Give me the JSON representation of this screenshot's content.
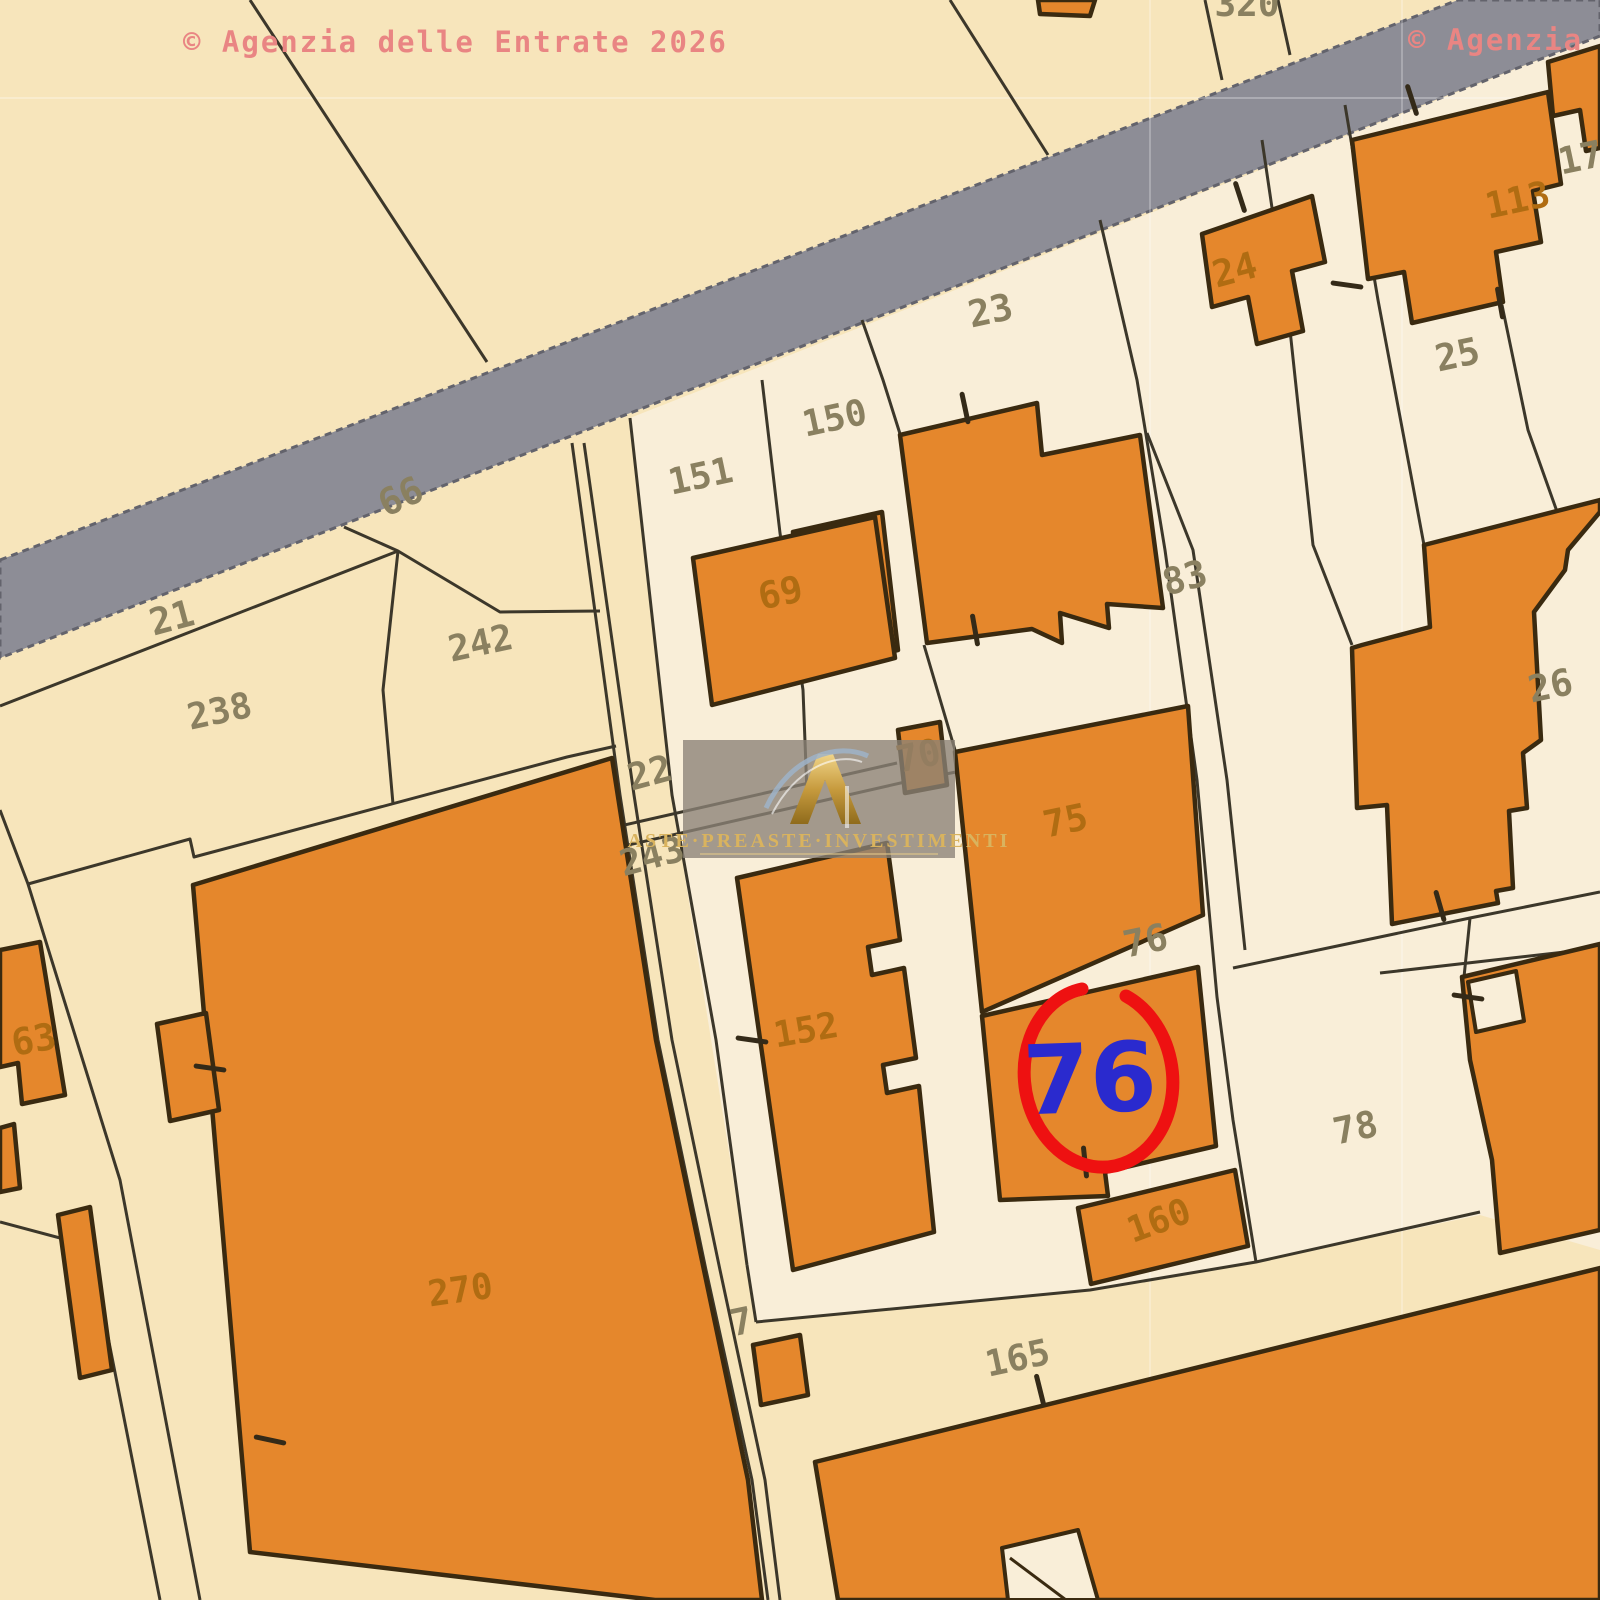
{
  "copyright": {
    "left": "© Agenzia delle Entrate 2026",
    "right": "© Agenzia"
  },
  "watermark": {
    "brand": "ASTE·PREASTE·INVESTIMENTI"
  },
  "colors": {
    "cream": "#f7e5bb",
    "cream_light": "#f9eed8",
    "road": "#8d8d96",
    "road_edge": "#63636c",
    "orange": "#e5872c",
    "building_stroke": "#3a2a10",
    "line": "#3c372a",
    "parcel_label": "#8a8060",
    "building_label": "#b06c12",
    "pink": "#e98583",
    "red": "#ee1111",
    "blue": "#2a2ace",
    "gold": "#d9b35e",
    "watermark_box": "rgba(138,130,118,0.78)"
  },
  "map": {
    "road": "0,560 1458,0 1600,0 1600,36 0,658",
    "light_zone": "630,418 1600,36 1600,1250 1480,1215 1256,1262 1090,1290 756,1322 747,1265 672,795",
    "grid": {
      "h": [
        98
      ],
      "v": [
        1150,
        1402
      ]
    },
    "boundaries": [
      "250,0 487,362",
      "950,0 1048,155",
      "1205,0 1222,80",
      "1278,0 1290,55",
      "0,706 398,551",
      "344,527 398,551 500,612 600,611",
      "398,551 383,690 393,804",
      "572,443 620,795 658,1040 706,1270 752,1480 768,1600",
      "584,443 634,795 672,1040 720,1270 765,1480 780,1600",
      "630,418 672,795 716,1040 747,1265",
      "620,826 897,763",
      "624,846 905,782 956,772",
      "28,884 190,839 194,857 567,757 616,746",
      "0,810 28,884 120,1180 200,1600",
      "0,1222 90,1246 160,1600",
      "1233,968 1470,918 1600,892",
      "1380,973 1600,948",
      "1470,918 1464,977",
      "756,1322 1090,1290 1256,1262 1480,1212",
      "747,1265 756,1322",
      "862,320 883,380 901,437",
      "924,645 955,750",
      "762,380 780,533 803,690 807,793",
      "1100,220 1137,380 1165,550 1197,780 1217,997 1233,1120 1256,1262",
      "1147,433 1193,550 1227,780 1245,950",
      "1262,140 1290,330 1313,545 1352,645",
      "1345,105 1378,300 1410,470 1424,545",
      "1502,305 1528,430 1560,520"
    ],
    "buildings": [
      {
        "n": "building-top-320",
        "pts": "1038,0 1095,0 1090,16 1040,14"
      },
      {
        "n": "building-24",
        "pts": "1202,234 1312,196 1325,262 1292,271 1303,331 1257,344 1248,297 1212,307"
      },
      {
        "n": "building-113",
        "pts": "1352,140 1548,92 1561,184 1533,191 1541,242 1496,252 1503,302 1412,323 1404,272 1368,279"
      },
      {
        "n": "building-17",
        "pts": "1548,62 1600,46 1600,148 1586,151 1580,110 1553,116"
      },
      {
        "n": "building-150-big",
        "pts": "900,435 1037,403 1042,455 1140,435 1163,608 1107,604 1109,628 1060,613 1062,643 1032,629 927,643"
      },
      {
        "n": "building-23-small",
        "pts": "793,532 882,512 898,650 808,670"
      },
      {
        "n": "building-69",
        "pts": "693,558 875,517 895,658 712,705"
      },
      {
        "n": "building-70",
        "pts": "898,730 940,722 947,785 905,793"
      },
      {
        "n": "building-75",
        "pts": "955,752 1188,706 1203,915 982,1012"
      },
      {
        "n": "building-26-big",
        "pts": "1362,645 1430,627 1424,545 1600,500 1600,512 1568,550 1565,570 1534,612 1541,740 1523,753 1527,808 1509,811 1513,888 1496,891 1498,903 1392,924 1387,805 1357,808 1352,648"
      },
      {
        "n": "building-76-highlighted",
        "pts": "982,1016 1198,967 1216,1146 1105,1172 1108,1196 1000,1200"
      },
      {
        "n": "building-152",
        "pts": "737,878 887,843 900,940 868,947 872,975 904,968 916,1058 883,1065 887,1093 919,1086 934,1232 793,1270"
      },
      {
        "n": "building-160",
        "pts": "1078,1208 1235,1170 1248,1246 1091,1284"
      },
      {
        "n": "building-right-78",
        "pts": "1462,977 1600,944 1600,1230 1500,1253 1492,1160 1470,1060"
      },
      {
        "n": "building-bottom-165",
        "pts": "815,1462 1600,1268 1600,1600 838,1600"
      },
      {
        "n": "building-270",
        "pts": "193,885 612,758 656,1040 704,1270 748,1480 762,1600 655,1600 250,1552"
      },
      {
        "n": "building-63",
        "pts": "0,950 40,942 65,1095 22,1104 18,1063 0,1067"
      },
      {
        "n": "building-left-rect",
        "pts": "157,1024 206,1013 219,1110 170,1121"
      },
      {
        "n": "building-left-sliver",
        "pts": "0,1128 14,1124 20,1188 0,1192"
      },
      {
        "n": "building-thin-diagonal",
        "pts": "58,1215 90,1207 112,1370 80,1378"
      },
      {
        "n": "building-small-7",
        "pts": "753,1345 800,1335 808,1395 761,1405"
      }
    ],
    "notches": [
      {
        "n": "notch-right-78",
        "pts": "1468,982 1516,971 1524,1021 1476,1032"
      },
      {
        "n": "notch-bottom-165",
        "pts": "1002,1548 1078,1530 1098,1600 1008,1600"
      }
    ],
    "notch_lines": [
      "1010,1558 1066,1600"
    ],
    "labels": [
      {
        "t": "320",
        "x": 1247,
        "y": 16,
        "r": 0,
        "k": "par"
      },
      {
        "t": "23",
        "x": 993,
        "y": 323,
        "r": -12,
        "k": "par"
      },
      {
        "t": "150",
        "x": 837,
        "y": 430,
        "r": -12,
        "k": "par"
      },
      {
        "t": "151",
        "x": 703,
        "y": 488,
        "r": -12,
        "k": "par"
      },
      {
        "t": "66",
        "x": 406,
        "y": 508,
        "r": -25,
        "k": "par"
      },
      {
        "t": "21",
        "x": 175,
        "y": 630,
        "r": -15,
        "k": "par"
      },
      {
        "t": "242",
        "x": 483,
        "y": 655,
        "r": -12,
        "k": "par"
      },
      {
        "t": "238",
        "x": 222,
        "y": 723,
        "r": -12,
        "k": "par"
      },
      {
        "t": "22",
        "x": 653,
        "y": 785,
        "r": -15,
        "k": "par"
      },
      {
        "t": "243",
        "x": 655,
        "y": 868,
        "r": -15,
        "k": "par"
      },
      {
        "t": "83",
        "x": 1188,
        "y": 590,
        "r": -15,
        "k": "par"
      },
      {
        "t": "76",
        "x": 1148,
        "y": 953,
        "r": -12,
        "k": "par"
      },
      {
        "t": "25",
        "x": 1460,
        "y": 367,
        "r": -12,
        "k": "par"
      },
      {
        "t": "17",
        "x": 1583,
        "y": 170,
        "r": -12,
        "k": "par"
      },
      {
        "t": "26",
        "x": 1553,
        "y": 698,
        "r": -12,
        "k": "par"
      },
      {
        "t": "78",
        "x": 1358,
        "y": 1140,
        "r": -12,
        "k": "par"
      },
      {
        "t": "165",
        "x": 1020,
        "y": 1370,
        "r": -12,
        "k": "par"
      },
      {
        "t": "7",
        "x": 744,
        "y": 1334,
        "r": -12,
        "k": "par"
      },
      {
        "t": "24",
        "x": 1238,
        "y": 282,
        "r": -15,
        "k": "bldg"
      },
      {
        "t": "113",
        "x": 1520,
        "y": 212,
        "r": -12,
        "k": "bldg"
      },
      {
        "t": "69",
        "x": 783,
        "y": 605,
        "r": -12,
        "k": "bldg"
      },
      {
        "t": "70",
        "x": 921,
        "y": 768,
        "r": -12,
        "k": "bldg"
      },
      {
        "t": "75",
        "x": 1068,
        "y": 833,
        "r": -12,
        "k": "bldg"
      },
      {
        "t": "152",
        "x": 808,
        "y": 1042,
        "r": -10,
        "k": "bldg"
      },
      {
        "t": "160",
        "x": 1163,
        "y": 1232,
        "r": -20,
        "k": "bldg"
      },
      {
        "t": "270",
        "x": 462,
        "y": 1302,
        "r": -8,
        "k": "bldg"
      },
      {
        "t": "63",
        "x": 36,
        "y": 1052,
        "r": -10,
        "k": "bldg"
      }
    ],
    "ticks": [
      [
        965,
        408,
        78
      ],
      [
        975,
        630,
        80
      ],
      [
        1240,
        197,
        72
      ],
      [
        1412,
        100,
        72
      ],
      [
        1347,
        285,
        8
      ],
      [
        1500,
        303,
        80
      ],
      [
        1468,
        997,
        8
      ],
      [
        1440,
        906,
        74
      ],
      [
        1085,
        1162,
        84
      ],
      [
        752,
        1040,
        8
      ],
      [
        210,
        1068,
        8
      ],
      [
        270,
        1440,
        12
      ],
      [
        1040,
        1390,
        76
      ]
    ],
    "marker": {
      "arc": "M1082,989 A74,90 -8 1 0 1126,996",
      "label": "76",
      "x": 1091,
      "y": 1112,
      "rot": -2
    }
  }
}
